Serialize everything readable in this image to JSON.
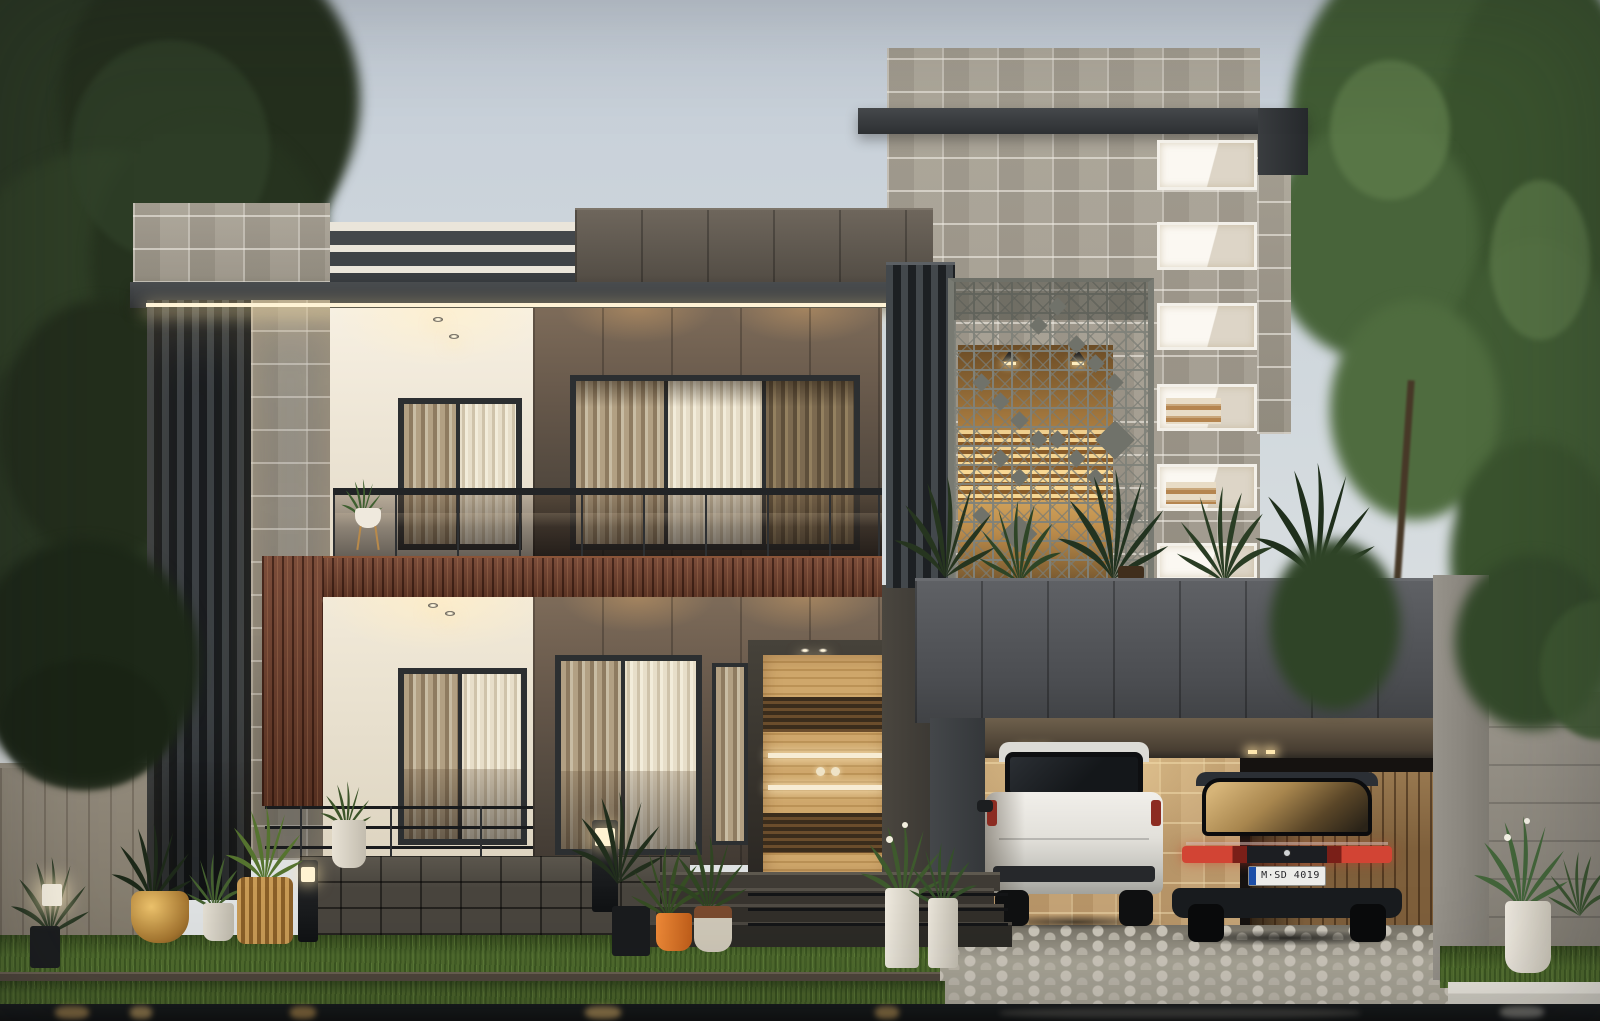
{
  "scene": {
    "type": "3D architectural exterior visualization",
    "subject": "Modern two-storey villa at dusk with stone, bronze-panel and timber facades",
    "time_of_day": "dusk"
  },
  "vehicles": {
    "sedan": {
      "color": "black",
      "license_plate": "M·SD 4019",
      "plate_band": "EU blue"
    },
    "suv": {
      "color": "white"
    }
  },
  "objects": [
    "left dark tree",
    "right green tree",
    "stone stair tower with lit staircase windows",
    "diamond lattice privacy screen",
    "roof terrace with tropical plants",
    "upper balcony with smoked glass balustrade",
    "bronze panel facade",
    "timber accent band and column",
    "timber entrance door with lit handle strips",
    "carport with two cars",
    "cobblestone driveway",
    "front lawn with planter pots",
    "garden bollard lights",
    "boundary walls",
    "reflecting water strip"
  ],
  "palette": {
    "sky_top": "#c5ced8",
    "sky_bottom": "#dfe2e3",
    "stone_grey": "#a59e90",
    "stone_tan": "#c19e6f",
    "fascia_dark": "#3a3d40",
    "bronze_wall": "#5d5145",
    "wood_accent": "#713f2b",
    "white_wall": "#efe8db",
    "slats": "#43484c",
    "lattice": "#7a7c74",
    "curtain": "#b2a083",
    "glass_tint": "#2b2421",
    "grass": "#4f6b2d",
    "driveway": "#a8a496",
    "water": "#101314",
    "foliage_left": "#2a3823",
    "foliage_right": "#46613a",
    "pot_gold": "#c09045",
    "pot_orange": "#dd7428",
    "led_warm": "#fff3d6"
  }
}
